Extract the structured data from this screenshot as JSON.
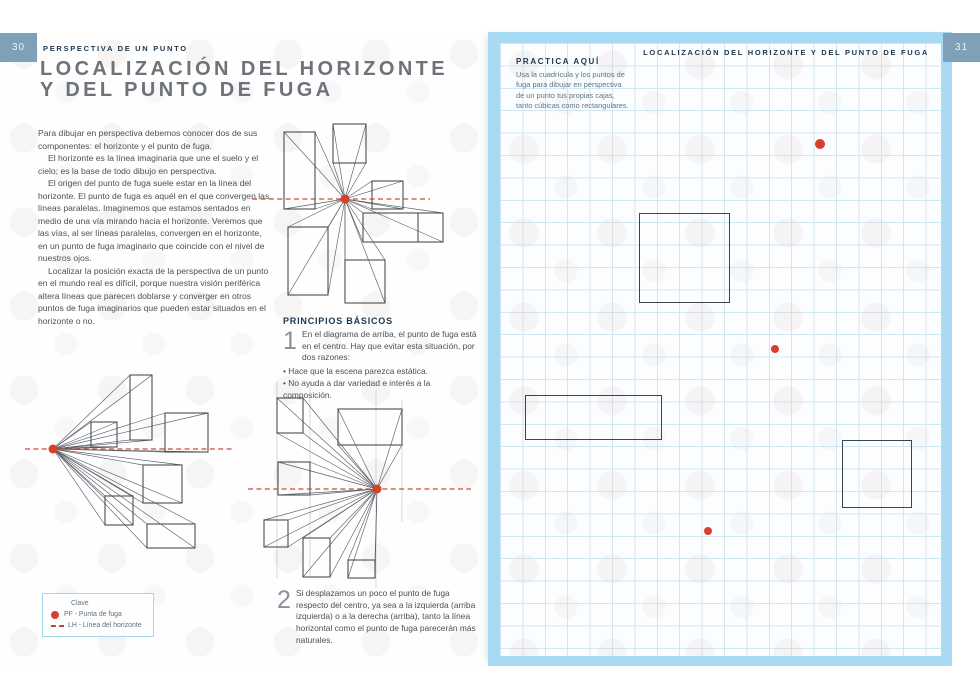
{
  "page_left": {
    "page_number": "30",
    "section_header": "PERSPECTIVA DE UN PUNTO",
    "title_line1": "LOCALIZACIÓN DEL HORIZONTE",
    "title_line2": "Y DEL PUNTO DE FUGA",
    "paragraphs": [
      "Para dibujar en perspectiva debemos conocer dos de sus componentes: el horizonte y el punto de fuga.",
      "El horizonte es la línea imaginaria que une el suelo y el cielo; es la base de todo dibujo en perspectiva.",
      "El origen del punto de fuga suele estar en la línea del horizonte. El punto de fuga es aquél en el que convergen las líneas paralelas. Imaginemos que estamos sentados en medio de una vía mirando hacia el horizonte. Veremos que las vías, al ser líneas paralelas, convergen en el horizonte, en un punto de fuga imaginario que coincide con el nivel de nuestros ojos.",
      "Localizar la posición exacta de la perspectiva de un punto en el mundo real es difícil, porque nuestra visión periférica altera líneas que parecen doblarse y converger en otros puntos de fuga imaginarios que pueden estar situados en el horizonte o no."
    ],
    "principios": {
      "heading": "PRINCIPIOS BÁSICOS",
      "step1_number": "1",
      "step1_text": "En el diagrama de arriba, el punto de fuga está en el centro. Hay que evitar esta situación, por dos razones:",
      "bullets": [
        "Hace que la escena parezca estática.",
        "No ayuda a dar variedad e interés a la composición."
      ],
      "step2_number": "2",
      "step2_text": "Si desplazamos un poco el punto de fuga respecto del centro, ya sea a la izquierda (arriba izquierda) o a la derecha (arriba), tanto la línea horizontal como el punto de fuga parecerán más naturales."
    },
    "legend": {
      "title": "Clave",
      "items": [
        {
          "icon": "vanishing-point-dot",
          "label": "PF - Punta de fuga"
        },
        {
          "icon": "horizon-dash",
          "label": "LH - Línea del horizonte"
        }
      ]
    }
  },
  "page_right": {
    "page_number": "31",
    "section_header": "LOCALIZACIÓN DEL HORIZONTE Y DEL PUNTO DE FUGA",
    "practice": {
      "heading": "PRACTICA AQUÍ",
      "body": "Usa la cuadrícula y los puntos de fuga para dibujar en perspectiva de un punto tus propias cajas, tanto cúbicas como rectangulares."
    }
  },
  "colors": {
    "accent_red": "#d8402c",
    "horizon_red": "#cf4a36",
    "frame_blue": "#a9daf3",
    "grid_blue": "#d2e7f4",
    "badge_blue": "#7fa0b9",
    "title_gray": "#6e737a",
    "heading_navy": "#20394e",
    "line_dark": "#474e55"
  }
}
